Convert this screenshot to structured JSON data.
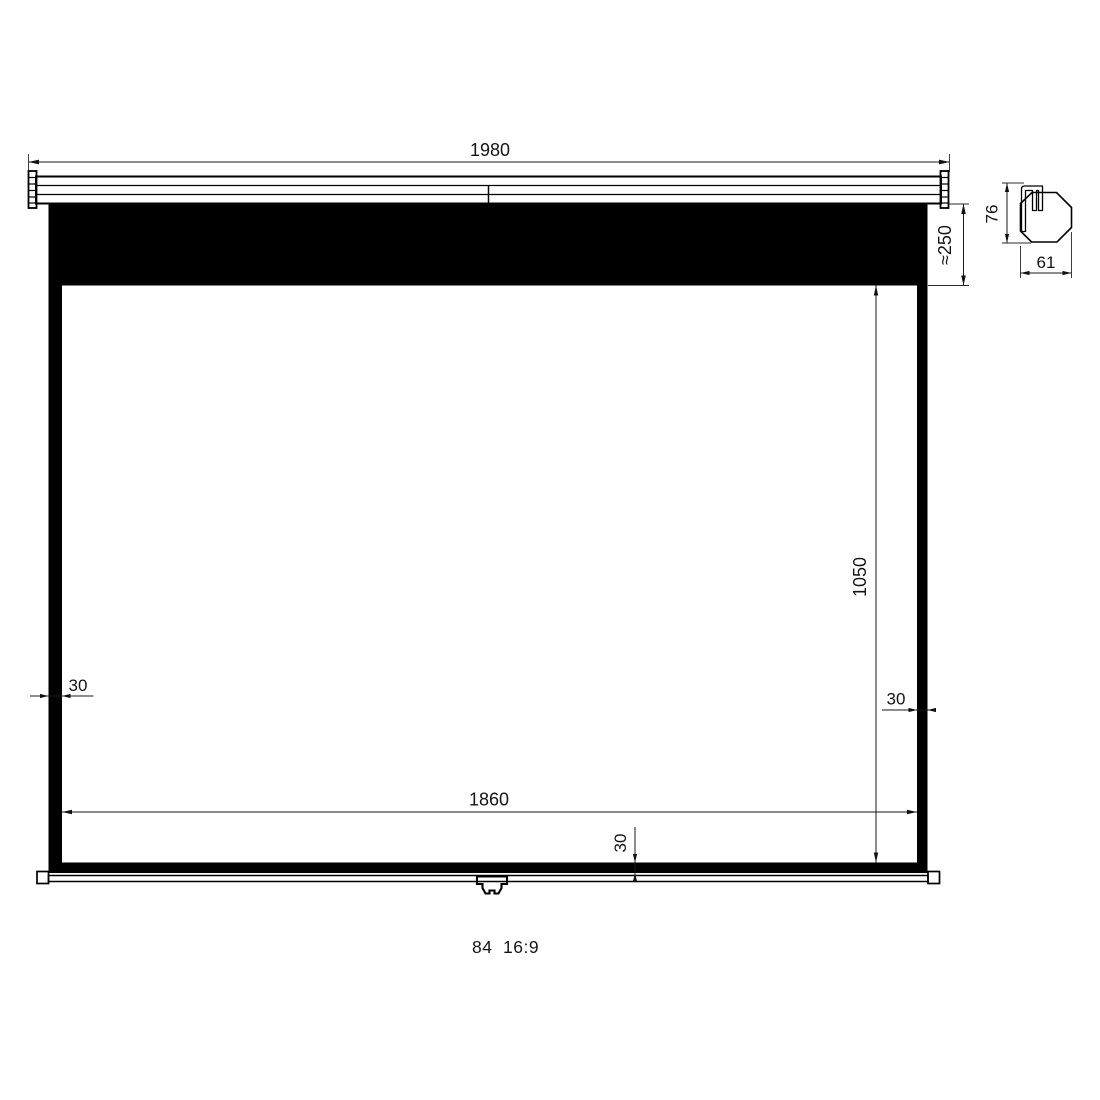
{
  "title": "Projection screen dimensional drawing",
  "caption": {
    "size": "84",
    "ratio": "16:9"
  },
  "front_view": {
    "dims": {
      "overall_width": "1980",
      "black_drop": "≈250",
      "viewing_height": "1050",
      "viewing_width": "1860",
      "left_border": "30",
      "right_border": "30",
      "bottom_border": "30"
    }
  },
  "side_view": {
    "dims": {
      "height": "76",
      "depth": "61"
    }
  },
  "colors": {
    "ink": "#000000",
    "dim_line": "#1a1a1a",
    "paper": "#ffffff"
  }
}
